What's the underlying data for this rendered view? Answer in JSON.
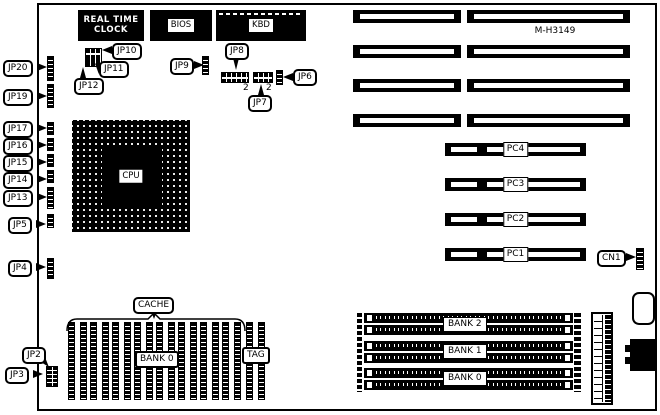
{
  "board": {
    "model": "M-H3149"
  },
  "chips": {
    "rtc_line1": "REAL TIME",
    "rtc_line2": "CLOCK",
    "bios": "BIOS",
    "kbd": "KBD",
    "cpu": "CPU"
  },
  "jumpers": {
    "jp20": "JP20",
    "jp19": "JP19",
    "jp17": "JP17",
    "jp16": "JP16",
    "jp15": "JP15",
    "jp14": "JP14",
    "jp13": "JP13",
    "jp5": "JP5",
    "jp4": "JP4",
    "jp2": "JP2",
    "jp3": "JP3",
    "jp10": "JP10",
    "jp11": "JP11",
    "jp12": "JP12",
    "jp9": "JP9",
    "jp8": "JP8",
    "jp7": "JP7",
    "jp6": "JP6"
  },
  "pin_numbers": {
    "jp8_pin": "2",
    "jp7_pin": "2"
  },
  "pc_slots": {
    "pc4": "PC4",
    "pc3": "PC3",
    "pc2": "PC2",
    "pc1": "PC1"
  },
  "connectors": {
    "cn1": "CN1"
  },
  "memory_banks": {
    "bank2": "BANK 2",
    "bank1": "BANK 1",
    "bank0": "BANK 0"
  },
  "cache": {
    "label": "CACHE",
    "bank0": "BANK 0",
    "tag": "TAG"
  },
  "colors": {
    "line": "#000000",
    "background": "#ffffff"
  }
}
